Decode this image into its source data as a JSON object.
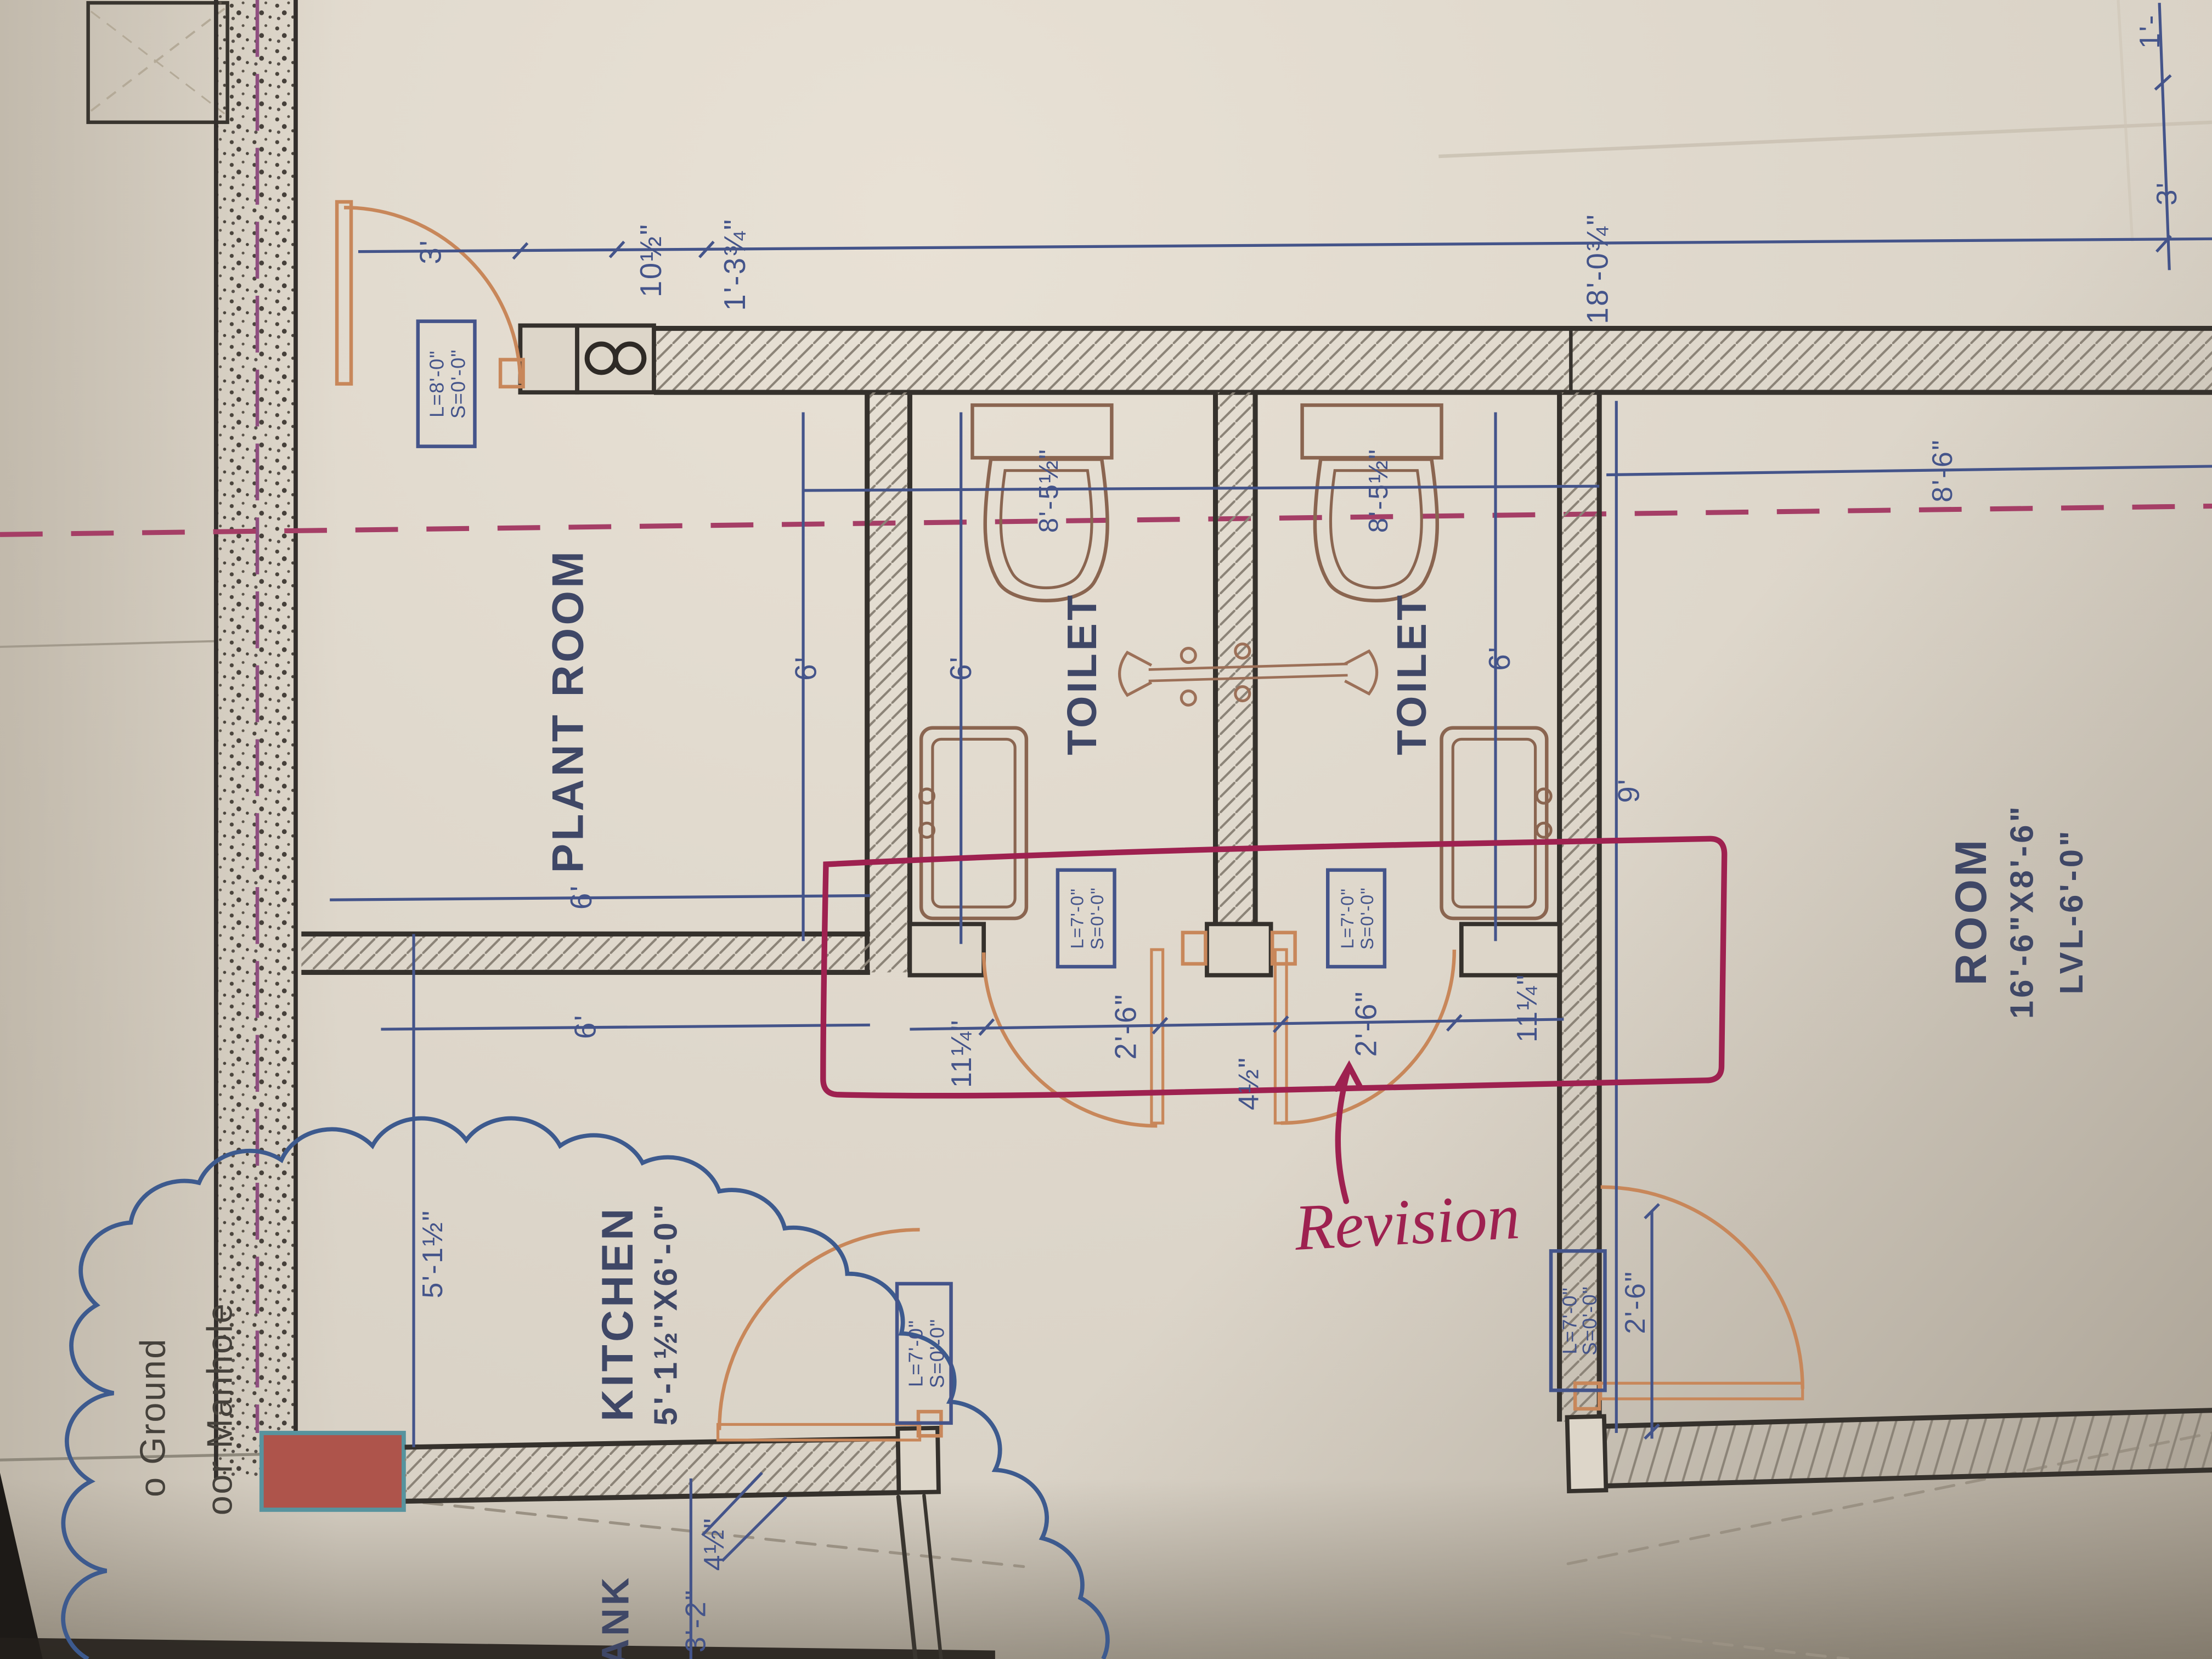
{
  "annotation": {
    "revision_label": "Revision"
  },
  "rooms": {
    "plant_room": {
      "name": "PLANT ROOM"
    },
    "toilet_left": {
      "name": "TOILET"
    },
    "toilet_right": {
      "name": "TOILET"
    },
    "kitchen": {
      "name": "KITCHEN",
      "size": "5'-1½\"X6'-0\""
    },
    "room": {
      "name": "ROOM",
      "size": "16'-6\"X8'-6\"",
      "level": "LVL-6'-0\""
    },
    "tank": {
      "name": "ANK"
    }
  },
  "notes": {
    "ground_line1": "o Ground",
    "ground_line2": "oor Manhole"
  },
  "door_tags": {
    "main_door": {
      "line1": "L=8'-0\"",
      "line2": "S=0'-0\""
    },
    "toilet_left_door": {
      "line1": "L=7'-0\"",
      "line2": "S=0'-0\""
    },
    "toilet_right_door": {
      "line1": "L=7'-0\"",
      "line2": "S=0'-0\""
    },
    "kitchen_door": {
      "line1": "L=7'-0\"",
      "line2": "S=0'-0\""
    },
    "room_door": {
      "line1": "L=7'-0\"",
      "line2": "S=0'-0\""
    }
  },
  "dimensions": {
    "top_3ft": "3'",
    "top_10_half": "10½\"",
    "top_1_3_3q": "1'-3¾\"",
    "top_18": "18'-0¾\"",
    "right_1ft": "1'-",
    "right_3ft": "3'",
    "room_8_6": "8'-6\"",
    "room_9": "9'",
    "toilet_6_a": "6'",
    "toilet_6_b": "6'",
    "toilet_6_c": "6'",
    "toilet_left_depth": "8'-5½\"",
    "toilet_right_depth": "8'-5½\"",
    "door_left_jamb": "11¼\"",
    "door_left": "2'-6\"",
    "door_center": "4½\"",
    "door_right": "2'-6\"",
    "door_right_jamb": "11¼\"",
    "plant_6_a": "6'",
    "plant_6_b": "6'",
    "kitchen_width": "5'-1½\"",
    "kitchen_4_half": "4½\"",
    "kitchen_3_2": "3'-2\"",
    "room_door_2_6": "2'-6\""
  },
  "colors": {
    "paper": "#d9d2c6",
    "ink_dark": "#35312c",
    "dim_blue": "#44548a",
    "door_orange": "#c8875a",
    "fixture_brown": "#8a6550",
    "revision_maroon": "#9e2150",
    "centerline_maroon": "#a53e66",
    "block_red": "#ae544b"
  }
}
